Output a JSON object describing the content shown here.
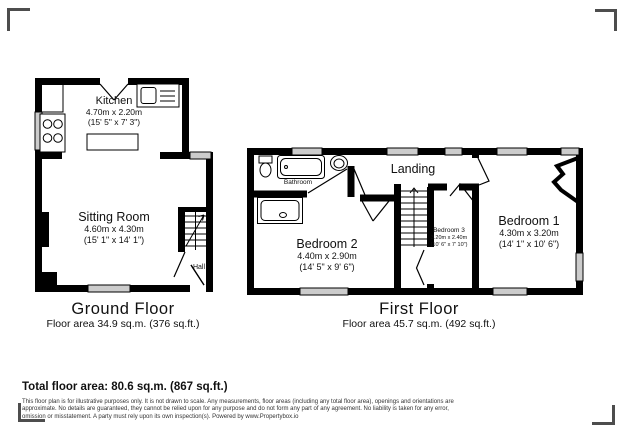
{
  "colors": {
    "wall": "#000000",
    "window_fill": "#cccccc",
    "corner_mark": "#4d4d4d"
  },
  "ground_floor": {
    "title": "Ground Floor",
    "area": "Floor area 34.9 sq.m. (376 sq.ft.)",
    "rooms": {
      "kitchen": {
        "name": "Kitchen",
        "metric": "4.70m x 2.20m",
        "imperial": "(15' 5\" x 7' 3\")"
      },
      "sitting_room": {
        "name": "Sitting Room",
        "metric": "4.60m x 4.30m",
        "imperial": "(15' 1\" x 14' 1\")"
      },
      "hall": {
        "name": "Hall"
      }
    }
  },
  "first_floor": {
    "title": "First Floor",
    "area": "Floor area 45.7 sq.m. (492 sq.ft.)",
    "rooms": {
      "bathroom": {
        "name": "Bathroom"
      },
      "landing": {
        "name": "Landing"
      },
      "bedroom_1": {
        "name": "Bedroom 1",
        "metric": "4.30m x 3.20m",
        "imperial": "(14' 1\" x 10' 6\")"
      },
      "bedroom_2": {
        "name": "Bedroom 2",
        "metric": "4.40m x 2.90m",
        "imperial": "(14' 5\" x 9' 6\")"
      },
      "bedroom_3": {
        "name": "Bedroom 3",
        "metric": "3.20m x 2.40m",
        "imperial": "(10' 6\" x 7' 10\")"
      }
    }
  },
  "summary": {
    "total": "Total floor area: 80.6 sq.m. (867 sq.ft.)"
  },
  "disclaimer": {
    "line1": "This floor plan is for illustrative purposes only. It is not drawn to scale. Any measurements, floor areas (including any total floor area), openings and orientations are",
    "line2": "approximate. No details are guaranteed, they cannot be relied upon for any purpose and do not form any part of any agreement. No liability is taken for any error,",
    "line3": "omission or misstatement. A party must rely upon its own inspection(s). Powered by www.Propertybox.io"
  }
}
